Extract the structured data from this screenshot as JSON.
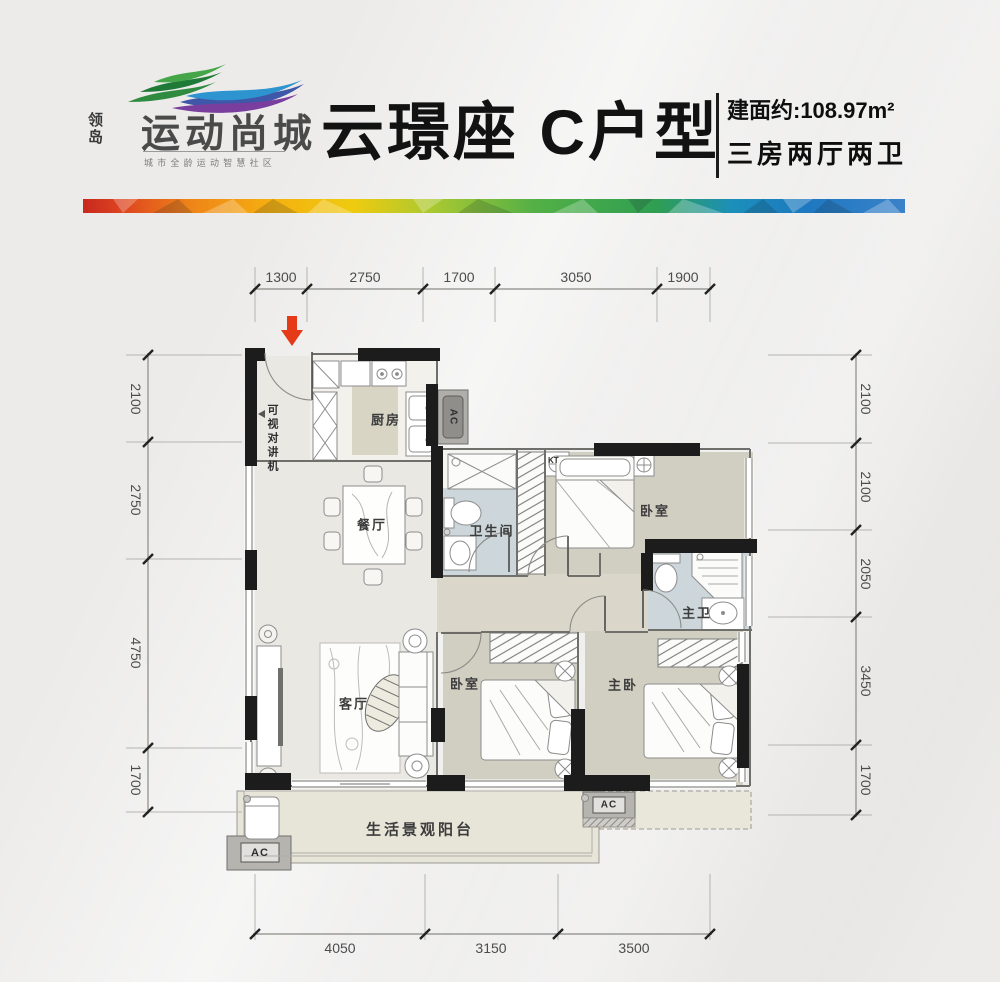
{
  "brand": {
    "name_vertical": "领岛",
    "name_main": "运动尚城",
    "tagline": "城市全龄运动智慧社区"
  },
  "header": {
    "title": "云璟座 C户型",
    "area": "建面约:108.97m²",
    "rooms_summary": "三房两厅两卫"
  },
  "plan": {
    "intercom": "可视对讲机",
    "rooms": {
      "kitchen": "厨房",
      "dining": "餐厅",
      "bathroom": "卫生间",
      "bedroom_top": "卧室",
      "master_bathroom": "主卫",
      "living": "客厅",
      "bedroom_mid": "卧室",
      "master_bedroom": "主卧",
      "balcony": "生活景观阳台"
    },
    "equipment": {
      "ac": "AC",
      "kt": "KT"
    },
    "dims": {
      "top": [
        "1300",
        "2750",
        "1700",
        "3050",
        "1900"
      ],
      "left": [
        "2100",
        "2750",
        "4750",
        "1700"
      ],
      "right": [
        "2100",
        "2100",
        "2050",
        "3450",
        "1700"
      ],
      "bottom": [
        "4050",
        "3150",
        "3500"
      ]
    }
  },
  "colors": {
    "accent_red": "#e53917",
    "wall": "#1c1c1c",
    "bath_floor": "#ccd6db",
    "bedroom_floor": "#d1cec2",
    "balcony_floor": "#e7e4d8",
    "rainbow": [
      "#c8281e",
      "#ee8418",
      "#f5b010",
      "#8fbe36",
      "#2f9e53",
      "#1d78c0",
      "#3b82c9"
    ]
  }
}
